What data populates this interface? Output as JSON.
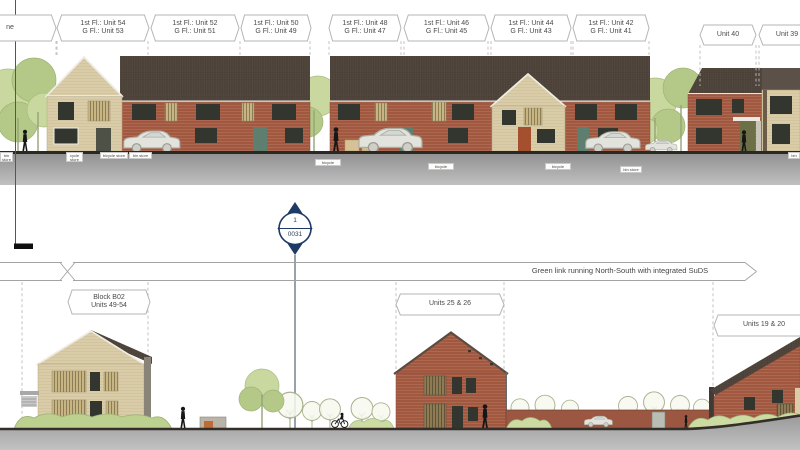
{
  "colors": {
    "brick_red": "#a2573f",
    "brick_buff": "#d9cca7",
    "roof_dark": "#4d4339",
    "roof_mid": "#5b5149",
    "ground_gray": "#9d9d9d",
    "tree_green": "#c9d89e",
    "tree_green_dark": "#b4c987",
    "hedge_green": "#bcd08f",
    "marker_navy": "#1e3a66",
    "tag_border": "#b5b5b5",
    "text_gray": "#4a4a4a",
    "window_dark": "#32362f"
  },
  "top_elevation": {
    "tags": [
      {
        "line1": "ne",
        "line2": ""
      },
      {
        "line1": "1st Fl.: Unit 54",
        "line2": "G Fl.: Unit 53"
      },
      {
        "line1": "1st Fl.: Unit 52",
        "line2": "G Fl.: Unit 51"
      },
      {
        "line1": "1st Fl.: Unit 50",
        "line2": "G Fl.: Unit 49"
      },
      {
        "line1": "1st Fl.: Unit 48",
        "line2": "G Fl.: Unit 47"
      },
      {
        "line1": "1st Fl.: Unit 46",
        "line2": "G Fl.: Unit 45"
      },
      {
        "line1": "1st Fl.: Unit 44",
        "line2": "G Fl.: Unit 43"
      },
      {
        "line1": "1st Fl.: Unit 42",
        "line2": "G Fl.: Unit 41"
      },
      {
        "line1": "Unit 40",
        "line2": ""
      },
      {
        "line1": "Unit 39",
        "line2": ""
      }
    ],
    "store_tags": [
      {
        "text": "bin store"
      },
      {
        "text": "cycle store"
      },
      {
        "text": "bicycle store"
      },
      {
        "text": "bin store"
      },
      {
        "text": "bicycle store"
      },
      {
        "text": "bicycle store"
      },
      {
        "text": "bicycle store"
      },
      {
        "text": "bin store"
      },
      {
        "text": "bin store"
      }
    ]
  },
  "section_marker": {
    "detail_number": "1",
    "sheet_number": "0031"
  },
  "bottom_elevation": {
    "band_label": "Green link running North-South with integrated SuDS",
    "tags": [
      {
        "line1": "Block B02",
        "line2": "Units 49-54"
      },
      {
        "line1": "Units 25 & 26",
        "line2": ""
      },
      {
        "line1": "Units 19 & 20",
        "line2": ""
      }
    ]
  }
}
